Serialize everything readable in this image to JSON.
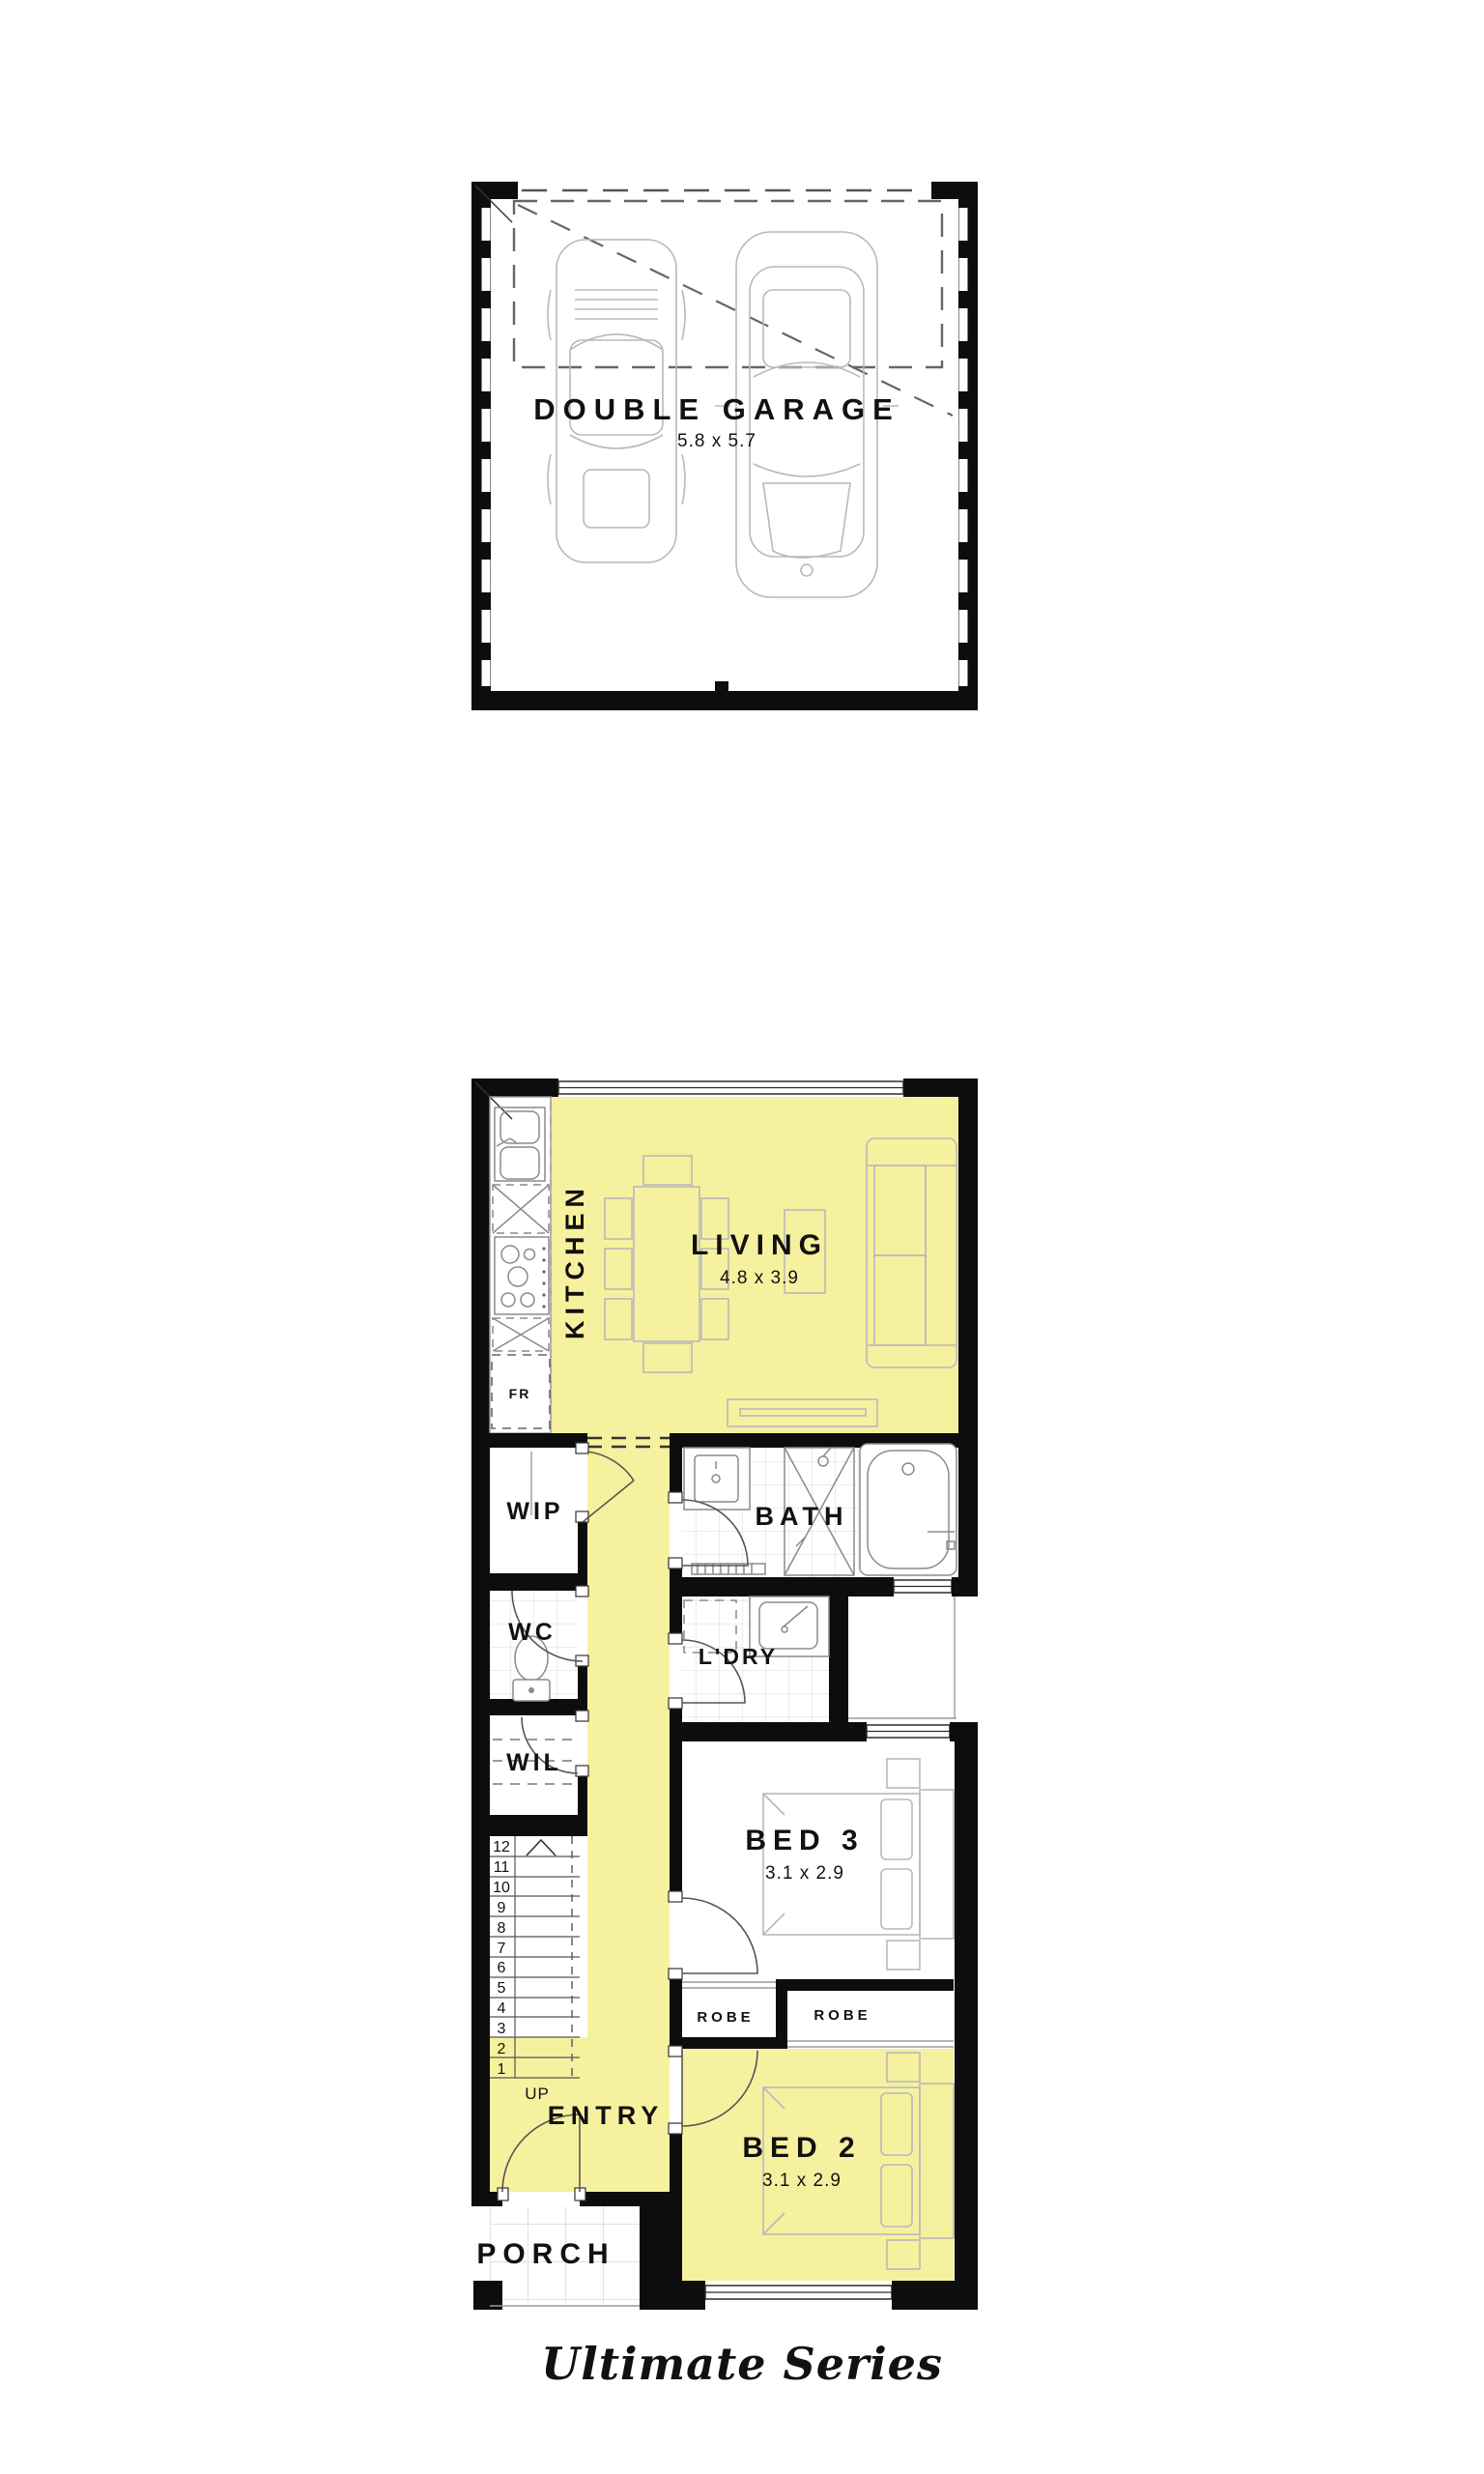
{
  "brand": {
    "series_label": "Ultimate Series"
  },
  "garage_plan": {
    "room_label": "DOUBLE GARAGE",
    "room_dimensions": "5.8 x 5.7"
  },
  "ground_plan": {
    "rooms": {
      "kitchen": {
        "label": "KITCHEN"
      },
      "living": {
        "label": "LIVING",
        "dimensions": "4.8 x 3.9"
      },
      "fridge": {
        "label": "FR"
      },
      "wip": {
        "label": "WIP"
      },
      "wc": {
        "label": "WC"
      },
      "wil": {
        "label": "WIL"
      },
      "bath": {
        "label": "BATH"
      },
      "laundry": {
        "label": "L'DRY"
      },
      "bed3": {
        "label": "BED 3",
        "dimensions": "3.1 x 2.9"
      },
      "robe_bed3": {
        "label": "ROBE"
      },
      "robe_bed2": {
        "label": "ROBE"
      },
      "bed2": {
        "label": "BED 2",
        "dimensions": "3.1 x 2.9"
      },
      "entry": {
        "label": "ENTRY"
      },
      "porch": {
        "label": "PORCH"
      }
    },
    "stairs": {
      "up_label": "UP",
      "treads": [
        "1",
        "2",
        "3",
        "4",
        "5",
        "6",
        "7",
        "8",
        "9",
        "10",
        "11",
        "12"
      ]
    },
    "highlight_color": "#f6f19e"
  }
}
